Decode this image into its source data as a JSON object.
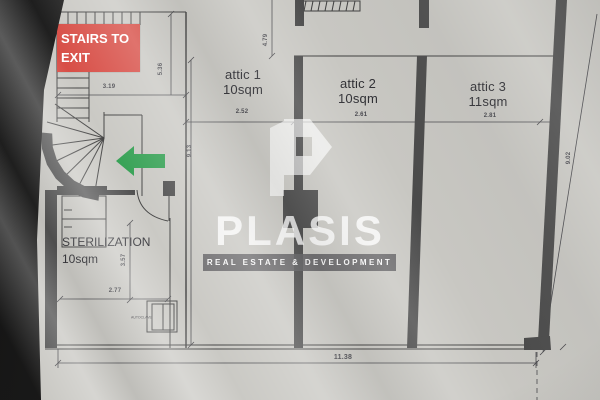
{
  "stairs_box": {
    "line1": "STAIRS TO",
    "line2": "EXIT"
  },
  "rooms": {
    "attic1": {
      "name": "attic 1",
      "area": "10sqm"
    },
    "attic2": {
      "name": "attic 2",
      "area": "10sqm"
    },
    "attic3": {
      "name": "attic 3",
      "area": "11sqm"
    },
    "sterilization": {
      "name": "STERILIZATION",
      "area": "10sqm"
    },
    "autoclave": {
      "label": "AUTOCLAVE"
    }
  },
  "dimensions": {
    "stairs_width": "3.19",
    "stairs_height": "5.36",
    "top_band_height": "4.79",
    "attic1_width": "2.52",
    "attic2_width": "2.61",
    "attic3_width": "2.81",
    "left_height": "9.13",
    "right_height": "9.02",
    "total_width": "11.38",
    "sterilization_width": "2.77",
    "sterilization_height": "3.57"
  },
  "watermark": {
    "brand": "PLASIS",
    "tagline": "REAL ESTATE & DEVELOPMENT"
  },
  "colors": {
    "paper": "#c8c7c2",
    "wall": "#4a4a4a",
    "line": "#3e3e3e",
    "exit_red": "#d6473f",
    "arrow_green": "#2f9e4f"
  }
}
